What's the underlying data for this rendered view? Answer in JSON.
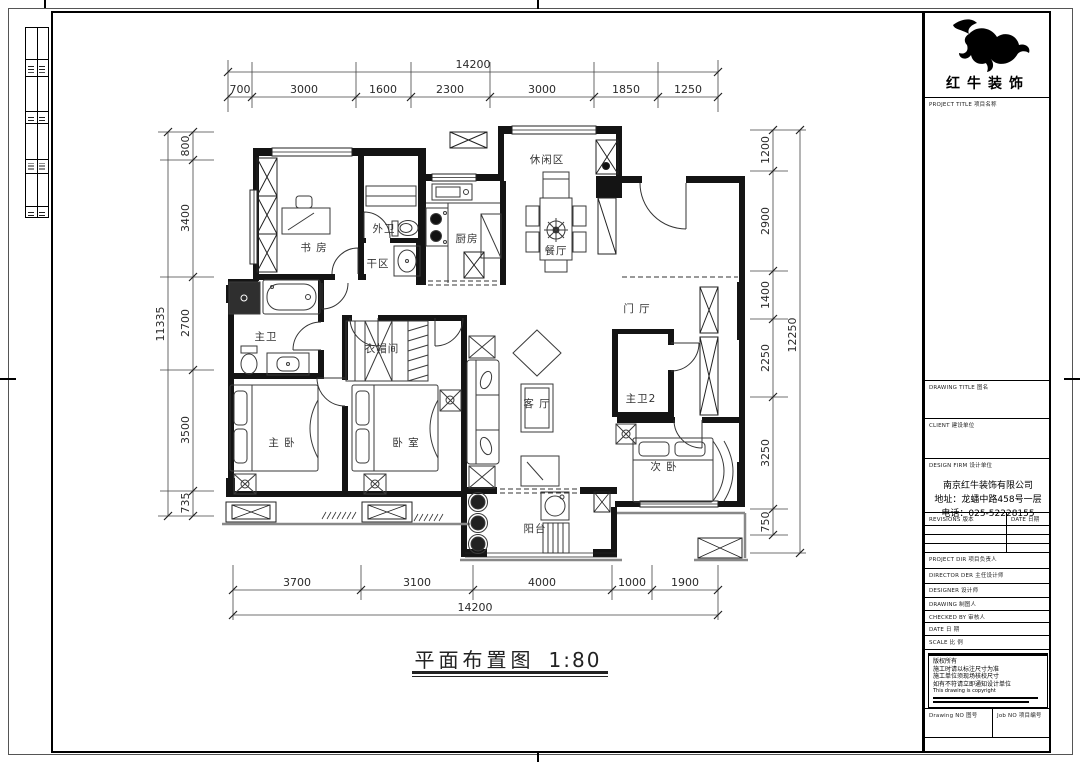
{
  "logo": {
    "company": "红牛装饰"
  },
  "titleblock": {
    "project_title": "PROJECT TITLE  项目名称",
    "drawing_title": "DRAWING TITLE  图名",
    "client": "CLIENT  建设单位",
    "design_firm": "DESIGN FIRM  设计单位",
    "firm_name": "南京红牛装饰有限公司",
    "firm_address": "地址：龙蟠中路458号一层",
    "firm_phone": "电话：025-52228155",
    "revisions": "REVISIONS  版本",
    "rev_date": "DATE  日期",
    "project_dir": "PROJECT DIR  项目负责人",
    "director": "DIRECTOR DER  主任设计师",
    "designer": "DESIGNER  设计师",
    "drawing": "DRAWING  制图人",
    "checked": "CHECKED BY  审核人",
    "date": "DATE  日  期",
    "scale": "SCALE  比  例",
    "notes": {
      "l1": "版权所有",
      "l2": "施工时请以标注尺寸为准",
      "l3": "施工单位须现场核校尺寸",
      "l4": "如有不符请立即通知设计单位",
      "l5": "This drawing is copyright"
    },
    "drawing_no": "Drawing NO  图号",
    "job_no": "Job NO  项目编号"
  },
  "plan": {
    "title": "平面布置图",
    "scale": "1:80",
    "rooms": {
      "study": "书 房",
      "leisure": "休闲区",
      "kitchen": "厨房",
      "dining": "餐厅",
      "guest_bath": "外卫",
      "dry_area": "干区",
      "master_bath": "主卫",
      "foyer": "门 厅",
      "cloak": "衣帽间",
      "living": "客 厅",
      "master_bed": "主 卧",
      "bedroom": "卧 室",
      "second_bed": "次 卧",
      "master_bath2": "主卫2",
      "balcony": "阳台"
    }
  },
  "dims": {
    "top": {
      "overall": "14200",
      "segments": [
        "700",
        "3000",
        "1600",
        "2300",
        "3000",
        "1850",
        "1250"
      ]
    },
    "left": {
      "overall": "11335",
      "segments": [
        "800",
        "3400",
        "2700",
        "3500",
        "735"
      ]
    },
    "right": {
      "overall": "12250",
      "segments": [
        "1200",
        "2900",
        "1400",
        "2250",
        "3250",
        "750"
      ]
    },
    "bottom": {
      "overall": "14200",
      "segments": [
        "3700",
        "3100",
        "4000",
        "1000",
        "1900"
      ]
    }
  }
}
